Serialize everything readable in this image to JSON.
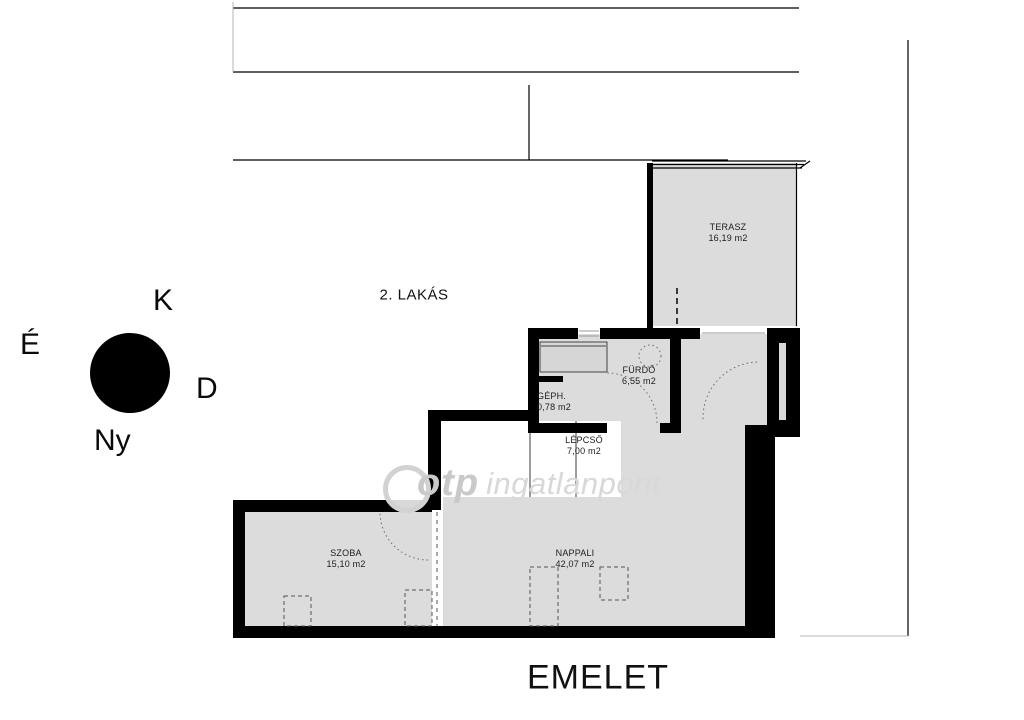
{
  "page": {
    "floor_title": "EMELET",
    "apartment_label": "2. LAKÁS",
    "watermark": {
      "brand": "otp",
      "name": "ingatlanpont"
    },
    "compass": {
      "east": "K",
      "north": "É",
      "south": "D",
      "west": "Ny"
    },
    "rooms": [
      {
        "name": "TERASZ",
        "area": "16,19 m2"
      },
      {
        "name": "FÜRDŐ",
        "area": "6,55 m2"
      },
      {
        "name": "GÉPH.",
        "area": "0,78 m2"
      },
      {
        "name": "LÉPCSŐ",
        "area": "7,00 m2"
      },
      {
        "name": "SZOBA",
        "area": "15,10 m2"
      },
      {
        "name": "NAPPALI",
        "area": "42,07 m2"
      }
    ],
    "colors": {
      "room_fill": "#dcdcdc",
      "wall": "#000000",
      "watermark_gray": "#d2d2d2"
    }
  }
}
